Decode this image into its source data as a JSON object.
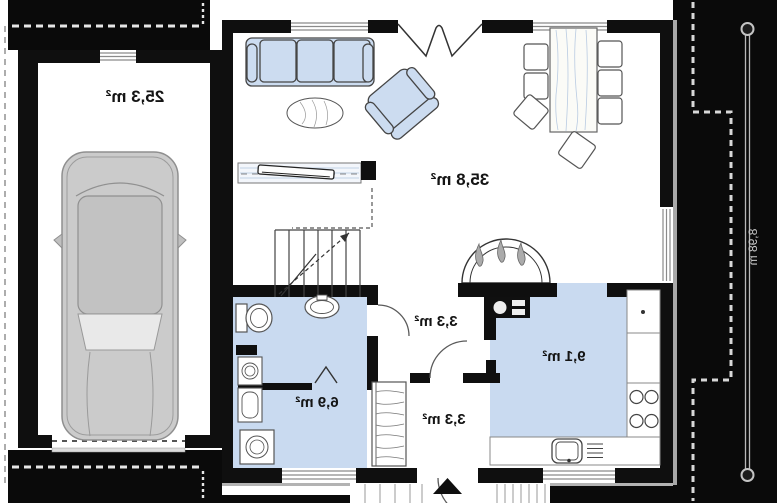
{
  "drawing": {
    "type": "floor-plan",
    "mirrored_text": true,
    "rooms": {
      "garage": "25,3 m²",
      "living_room": "35,8 m²",
      "hall": "3,3 m²",
      "bathroom": "6,9 m²",
      "vestibule": "3,3 m²",
      "kitchen": "9,1 m²"
    },
    "dimensions": {
      "plan_depth": "8,98 m"
    },
    "colors": {
      "wall": "#0f0f0f",
      "site_band": "#0a0a0a",
      "furniture_fill": "#ccdcf0",
      "room_fill": "#c9daf0",
      "car_body": "#cbcbcb",
      "background": "#ffffff",
      "window_line": "#8a8a8a"
    },
    "icons": [
      "sofa",
      "armchair",
      "rug",
      "tv-cabinet",
      "stairs",
      "fireplace",
      "dining-table",
      "chair",
      "car",
      "toilet",
      "washbasin",
      "washing-machine",
      "wardrobe",
      "stove",
      "kitchen-sink",
      "entrance-arrow",
      "dimension-line",
      "roof-outline",
      "property-line"
    ]
  }
}
